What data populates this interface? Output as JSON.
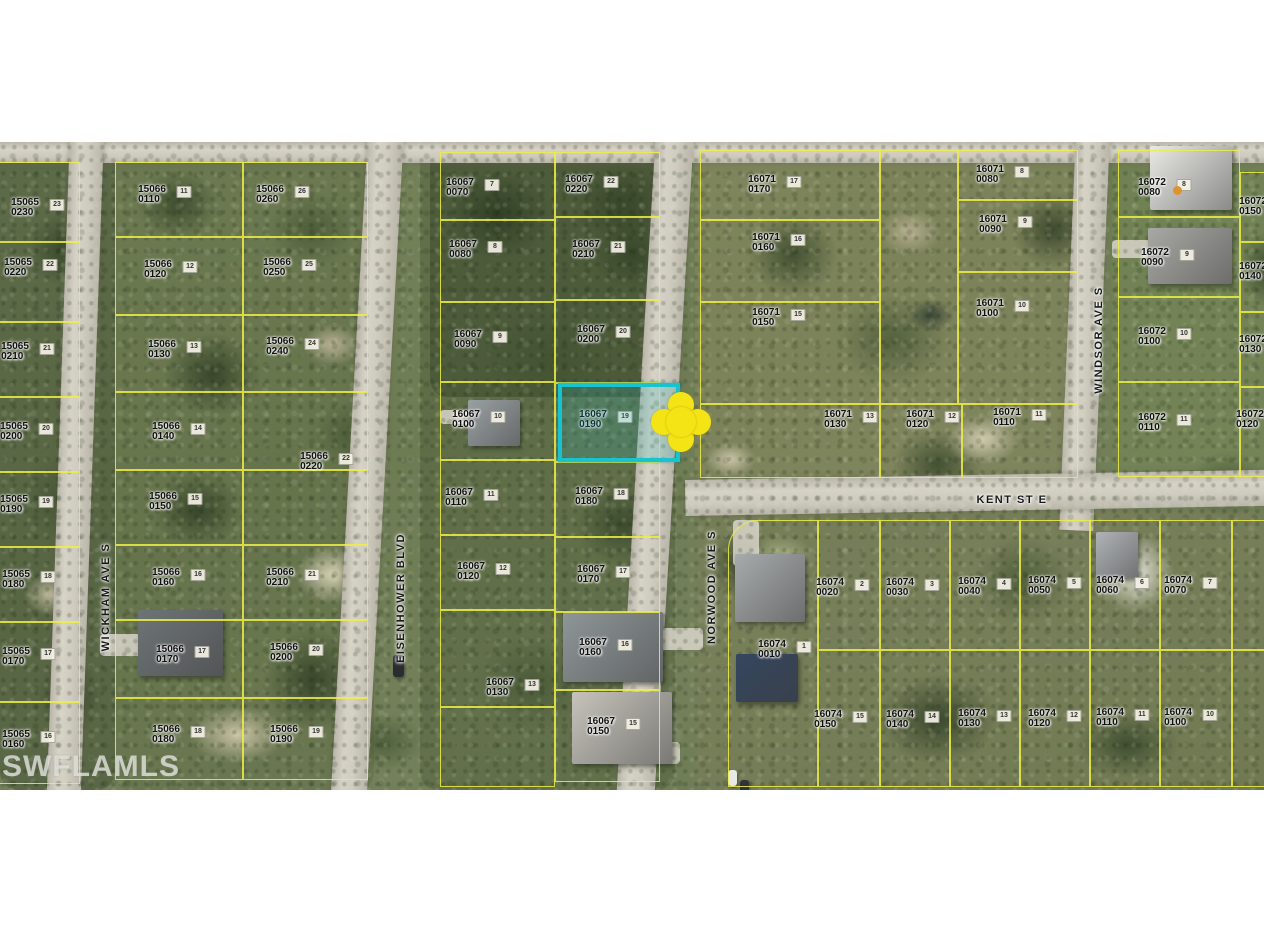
{
  "watermark": "SWFLAMLS",
  "map": {
    "parcel_line_color": "#efee46",
    "highlight": {
      "parcel": "16067 0190",
      "x": 558,
      "y": 241,
      "width": 122,
      "height": 79,
      "border_color": "#17c3cf",
      "fill": "rgba(40,185,195,0.20)",
      "marker": {
        "x": 681,
        "y": 280,
        "color": "#f4e415"
      }
    },
    "poi_dot": {
      "x": 1177,
      "y": 48,
      "color": "#dd9430"
    },
    "streets": [
      {
        "name": "WICKHAM AVE S",
        "x": 106,
        "y": 455,
        "rotation": "vertical"
      },
      {
        "name": "EISENHOWER BLVD",
        "x": 401,
        "y": 456,
        "rotation": "vertical"
      },
      {
        "name": "NORWOOD AVE S",
        "x": 712,
        "y": 445,
        "rotation": "vertical"
      },
      {
        "name": "WINDSOR AVE S",
        "x": 1099,
        "y": 198,
        "rotation": "vertical"
      },
      {
        "name": "KENT ST E",
        "x": 1012,
        "y": 358,
        "rotation": "horizontal"
      }
    ],
    "parcels": [
      {
        "block": "15065",
        "lot": "0230",
        "x": 25,
        "y": 66
      },
      {
        "block": "15065",
        "lot": "0220",
        "x": 18,
        "y": 126
      },
      {
        "block": "15065",
        "lot": "0210",
        "x": 15,
        "y": 210
      },
      {
        "block": "15065",
        "lot": "0200",
        "x": 14,
        "y": 290
      },
      {
        "block": "15065",
        "lot": "0190",
        "x": 14,
        "y": 363
      },
      {
        "block": "15065",
        "lot": "0180",
        "x": 16,
        "y": 438
      },
      {
        "block": "15065",
        "lot": "0170",
        "x": 16,
        "y": 515
      },
      {
        "block": "15065",
        "lot": "0160",
        "x": 16,
        "y": 598
      },
      {
        "block": "15066",
        "lot": "0110",
        "x": 152,
        "y": 53
      },
      {
        "block": "15066",
        "lot": "0120",
        "x": 158,
        "y": 128
      },
      {
        "block": "15066",
        "lot": "0130",
        "x": 162,
        "y": 208
      },
      {
        "block": "15066",
        "lot": "0140",
        "x": 166,
        "y": 290
      },
      {
        "block": "15066",
        "lot": "0150",
        "x": 163,
        "y": 360
      },
      {
        "block": "15066",
        "lot": "0160",
        "x": 166,
        "y": 436
      },
      {
        "block": "15066",
        "lot": "0170",
        "x": 170,
        "y": 513
      },
      {
        "block": "15066",
        "lot": "0180",
        "x": 166,
        "y": 593
      },
      {
        "block": "15066",
        "lot": "0260",
        "x": 270,
        "y": 53
      },
      {
        "block": "15066",
        "lot": "0250",
        "x": 277,
        "y": 126
      },
      {
        "block": "15066",
        "lot": "0240",
        "x": 280,
        "y": 205
      },
      {
        "block": "15066",
        "lot": "0220",
        "x": 314,
        "y": 320
      },
      {
        "block": "15066",
        "lot": "0210",
        "x": 280,
        "y": 436
      },
      {
        "block": "15066",
        "lot": "0200",
        "x": 284,
        "y": 511
      },
      {
        "block": "15066",
        "lot": "0190",
        "x": 284,
        "y": 593
      },
      {
        "block": "16067",
        "lot": "0070",
        "x": 460,
        "y": 46
      },
      {
        "block": "16067",
        "lot": "0080",
        "x": 463,
        "y": 108
      },
      {
        "block": "16067",
        "lot": "0090",
        "x": 468,
        "y": 198
      },
      {
        "block": "16067",
        "lot": "0100",
        "x": 466,
        "y": 278
      },
      {
        "block": "16067",
        "lot": "0110",
        "x": 459,
        "y": 356
      },
      {
        "block": "16067",
        "lot": "0120",
        "x": 471,
        "y": 430
      },
      {
        "block": "16067",
        "lot": "0130",
        "x": 500,
        "y": 546
      },
      {
        "block": "16067",
        "lot": "0220",
        "x": 579,
        "y": 43
      },
      {
        "block": "16067",
        "lot": "0210",
        "x": 586,
        "y": 108
      },
      {
        "block": "16067",
        "lot": "0200",
        "x": 591,
        "y": 193
      },
      {
        "block": "16067",
        "lot": "0190",
        "x": 593,
        "y": 278
      },
      {
        "block": "16067",
        "lot": "0180",
        "x": 589,
        "y": 355
      },
      {
        "block": "16067",
        "lot": "0170",
        "x": 591,
        "y": 433
      },
      {
        "block": "16067",
        "lot": "0160",
        "x": 593,
        "y": 506
      },
      {
        "block": "16067",
        "lot": "0150",
        "x": 601,
        "y": 585
      },
      {
        "block": "16071",
        "lot": "0170",
        "x": 762,
        "y": 43
      },
      {
        "block": "16071",
        "lot": "0160",
        "x": 766,
        "y": 101
      },
      {
        "block": "16071",
        "lot": "0150",
        "x": 766,
        "y": 176
      },
      {
        "block": "16071",
        "lot": "0130",
        "x": 838,
        "y": 278
      },
      {
        "block": "16071",
        "lot": "0120",
        "x": 920,
        "y": 278
      },
      {
        "block": "16071",
        "lot": "0110",
        "x": 1007,
        "y": 276
      },
      {
        "block": "16071",
        "lot": "0080",
        "x": 990,
        "y": 33
      },
      {
        "block": "16071",
        "lot": "0090",
        "x": 993,
        "y": 83
      },
      {
        "block": "16071",
        "lot": "0100",
        "x": 990,
        "y": 167
      },
      {
        "block": "16072",
        "lot": "0080",
        "x": 1152,
        "y": 46
      },
      {
        "block": "16072",
        "lot": "0090",
        "x": 1155,
        "y": 116
      },
      {
        "block": "16072",
        "lot": "0100",
        "x": 1152,
        "y": 195
      },
      {
        "block": "16072",
        "lot": "0110",
        "x": 1152,
        "y": 281
      },
      {
        "block": "16072",
        "lot": "0150",
        "x": 1253,
        "y": 65
      },
      {
        "block": "16072",
        "lot": "0140",
        "x": 1253,
        "y": 130
      },
      {
        "block": "16072",
        "lot": "0130",
        "x": 1253,
        "y": 203
      },
      {
        "block": "16072",
        "lot": "0120",
        "x": 1250,
        "y": 278
      },
      {
        "block": "16074",
        "lot": "0010",
        "x": 772,
        "y": 508
      },
      {
        "block": "16074",
        "lot": "0020",
        "x": 830,
        "y": 446
      },
      {
        "block": "16074",
        "lot": "0030",
        "x": 900,
        "y": 446
      },
      {
        "block": "16074",
        "lot": "0040",
        "x": 972,
        "y": 445
      },
      {
        "block": "16074",
        "lot": "0050",
        "x": 1042,
        "y": 444
      },
      {
        "block": "16074",
        "lot": "0060",
        "x": 1110,
        "y": 444
      },
      {
        "block": "16074",
        "lot": "0070",
        "x": 1178,
        "y": 444
      },
      {
        "block": "16074",
        "lot": "0150",
        "x": 828,
        "y": 578
      },
      {
        "block": "16074",
        "lot": "0140",
        "x": 900,
        "y": 578
      },
      {
        "block": "16074",
        "lot": "0130",
        "x": 972,
        "y": 577
      },
      {
        "block": "16074",
        "lot": "0120",
        "x": 1042,
        "y": 577
      },
      {
        "block": "16074",
        "lot": "0110",
        "x": 1110,
        "y": 576
      },
      {
        "block": "16074",
        "lot": "0100",
        "x": 1178,
        "y": 576
      }
    ]
  }
}
